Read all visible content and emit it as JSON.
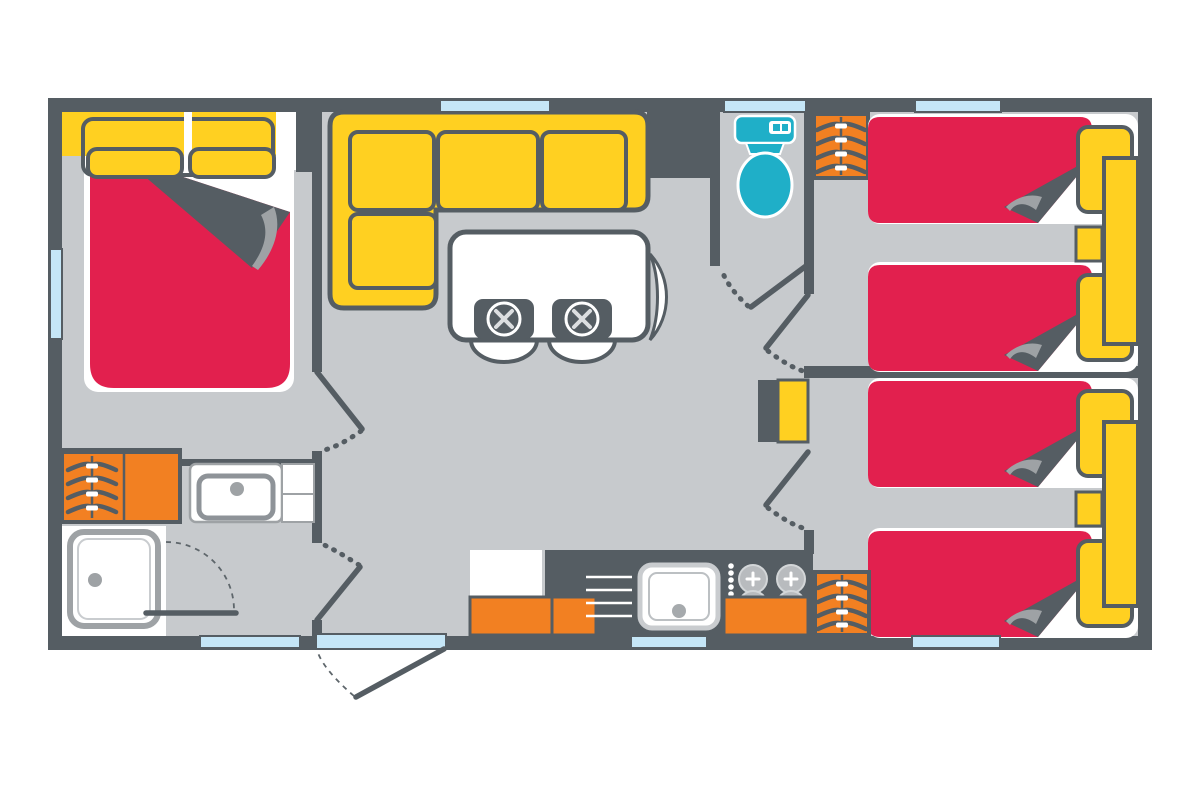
{
  "plan": {
    "kind": "mobile-home-floor-plan",
    "view": "top-down-schematic",
    "visible_text": ""
  },
  "colors": {
    "wall": "#555D63",
    "floor": "#C7CACD",
    "bedding_red": "#E2204E",
    "furniture_yellow": "#FFD021",
    "storage_orange": "#F28022",
    "sanitary_teal": "#1FAFC8",
    "window_blue": "#C5E6F7",
    "detail_gray": "#9EA2A5",
    "fixture_white": "#FFFFFF"
  },
  "rooms": {
    "master_bedroom": {
      "furniture": [
        "double-bed",
        "headboard-with-two-pillows",
        "folded-duvet",
        "wardrobe-with-hangers"
      ],
      "windows": 1,
      "doors": 1
    },
    "shower_room": {
      "furniture": [
        "shower-tray",
        "washbasin",
        "side-counter"
      ],
      "windows": 1,
      "doors": 1
    },
    "living_kitchen": {
      "furniture": [
        "l-shaped-sofa",
        "dining-table",
        "two-place-settings",
        "two-chairs",
        "curved-bench",
        "fridge-unit",
        "base-cabinets",
        "kitchen-counter",
        "kitchen-sink",
        "four-burner-hob",
        "drawer-unit",
        "wardrobe-with-hangers"
      ],
      "windows": 2,
      "doors": 1,
      "entrance": "glazed-entrance-door"
    },
    "wc": {
      "furniture": [
        "toilet"
      ],
      "windows": 1,
      "doors": 1
    },
    "hallway": {
      "furniture": [
        "small-cabinet"
      ],
      "doors": 2
    },
    "bedroom_2": {
      "furniture": [
        "single-bed",
        "single-bed",
        "headboard-shelf",
        "nightstand",
        "wardrobe-with-hangers"
      ],
      "windows": 1,
      "doors": 1
    },
    "bedroom_3": {
      "furniture": [
        "single-bed",
        "single-bed",
        "headboard-shelf",
        "nightstand",
        "wardrobe-with-hangers"
      ],
      "windows": 1,
      "doors": 1
    }
  },
  "counts": {
    "single_beds": 4,
    "double_beds": 1,
    "windows_total": 7,
    "wardrobes": 4
  }
}
